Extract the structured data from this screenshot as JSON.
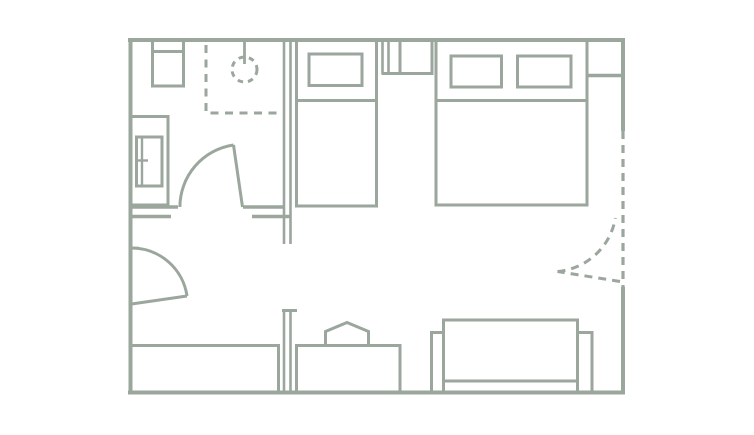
{
  "canvas": {
    "width": 754,
    "height": 435,
    "background": "#ffffff"
  },
  "plan": {
    "title": "hotel-room-floor-plan",
    "stroke_color": "#9ba69d",
    "fill_color": "none",
    "elements": [
      {
        "type": "line",
        "name": "wall-top",
        "x1": 128,
        "y1": 40,
        "x2": 625,
        "y2": 40,
        "sw": 4
      },
      {
        "type": "line",
        "name": "wall-left",
        "x1": 130.5,
        "y1": 38,
        "x2": 130.5,
        "y2": 394,
        "sw": 4
      },
      {
        "type": "line",
        "name": "wall-bottom",
        "x1": 128,
        "y1": 392.5,
        "x2": 625,
        "y2": 392.5,
        "sw": 4
      },
      {
        "type": "line",
        "name": "wall-right-upper",
        "x1": 623,
        "y1": 38,
        "x2": 623,
        "y2": 131,
        "sw": 4
      },
      {
        "type": "line",
        "name": "balcony-wall-dashed",
        "x1": 623,
        "y1": 131,
        "x2": 623,
        "y2": 289,
        "sw": 3.2,
        "dash": "8 6"
      },
      {
        "type": "line",
        "name": "wall-right-lower",
        "x1": 623,
        "y1": 287,
        "x2": 623,
        "y2": 394,
        "sw": 4
      },
      {
        "type": "line",
        "name": "bathroom-partition-outer",
        "x1": 284,
        "y1": 40,
        "x2": 284,
        "y2": 244,
        "sw": 2.6
      },
      {
        "type": "line",
        "name": "bathroom-partition-inner",
        "x1": 290.5,
        "y1": 40,
        "x2": 290.5,
        "y2": 244,
        "sw": 2.6
      },
      {
        "type": "line",
        "name": "bathroom-south-wall-left-outer",
        "x1": 129,
        "y1": 207,
        "x2": 178,
        "y2": 207,
        "sw": 3.5
      },
      {
        "type": "line",
        "name": "bathroom-south-wall-left-inner",
        "x1": 129,
        "y1": 216.5,
        "x2": 171,
        "y2": 216.5,
        "sw": 3.5
      },
      {
        "type": "line",
        "name": "bathroom-south-wall-right-outer",
        "x1": 243,
        "y1": 207,
        "x2": 285,
        "y2": 207,
        "sw": 3.5
      },
      {
        "type": "line",
        "name": "bathroom-south-wall-right-inner",
        "x1": 252,
        "y1": 216.5,
        "x2": 291.5,
        "y2": 216.5,
        "sw": 3.5
      },
      {
        "type": "line",
        "name": "hall-partition-outer",
        "x1": 284,
        "y1": 310,
        "x2": 284,
        "y2": 392,
        "sw": 2.6
      },
      {
        "type": "line",
        "name": "hall-partition-inner",
        "x1": 290.5,
        "y1": 310,
        "x2": 290.5,
        "y2": 392,
        "sw": 2.6
      },
      {
        "type": "line",
        "name": "hall-partition-cap",
        "x1": 282,
        "y1": 310.5,
        "x2": 297,
        "y2": 310.5,
        "sw": 3
      },
      {
        "type": "line",
        "name": "bedroom-divider-stub-outer",
        "x1": 382.5,
        "y1": 40,
        "x2": 382.5,
        "y2": 73.5,
        "sw": 2.6
      },
      {
        "type": "line",
        "name": "bedroom-divider-stub-inner",
        "x1": 388.5,
        "y1": 40,
        "x2": 388.5,
        "y2": 73.5,
        "sw": 2.6
      },
      {
        "type": "line",
        "name": "bedroom-divider-stub-cap",
        "x1": 381.5,
        "y1": 73.5,
        "x2": 400,
        "y2": 73.5,
        "sw": 3
      },
      {
        "type": "rect",
        "name": "sink",
        "x": 152.5,
        "y": 40,
        "w": 31,
        "h": 46,
        "sw": 3
      },
      {
        "type": "line",
        "name": "sink-basin-edge",
        "x1": 152.5,
        "y1": 51.5,
        "x2": 183.5,
        "y2": 51.5,
        "sw": 3
      },
      {
        "type": "rect",
        "name": "toilet-outer",
        "x": 130.5,
        "y": 116.5,
        "w": 37.5,
        "h": 88.5,
        "sw": 3
      },
      {
        "type": "rect",
        "name": "toilet-inner",
        "x": 136.5,
        "y": 137,
        "w": 25.5,
        "h": 49,
        "sw": 3
      },
      {
        "type": "line",
        "name": "toilet-divider",
        "x1": 142,
        "y1": 137,
        "x2": 142,
        "y2": 186,
        "sw": 2.4
      },
      {
        "type": "line",
        "name": "toilet-handle-tick",
        "x1": 135.5,
        "y1": 160.5,
        "x2": 148,
        "y2": 160.5,
        "sw": 2.4
      },
      {
        "type": "path",
        "name": "shower-enclosure-dashed",
        "d": "M 206 45 V 113 H 283",
        "sw": 3,
        "dash": "8 6.5"
      },
      {
        "type": "circle",
        "name": "shower-drain-circle",
        "cx": 244.5,
        "cy": 69.5,
        "r": 12.5,
        "sw": 3,
        "dash": "5.5 5"
      },
      {
        "type": "line",
        "name": "shower-head-line",
        "x1": 244.5,
        "y1": 40,
        "x2": 244.5,
        "y2": 64,
        "sw": 2.8
      },
      {
        "type": "line",
        "name": "bathroom-door-leaf",
        "x1": 242.5,
        "y1": 207,
        "x2": 233.5,
        "y2": 145,
        "sw": 3
      },
      {
        "type": "path",
        "name": "bathroom-door-swing-arc",
        "d": "M 179.9 207 A 62.7 62.7 0 0 1 233.5 145",
        "sw": 3
      },
      {
        "type": "line",
        "name": "entry-door-jamb-tick",
        "x1": 129,
        "y1": 248,
        "x2": 139,
        "y2": 248,
        "sw": 2.6
      },
      {
        "type": "line",
        "name": "entry-door-leaf",
        "x1": 131.5,
        "y1": 304,
        "x2": 187,
        "y2": 296,
        "sw": 3
      },
      {
        "type": "path",
        "name": "entry-door-swing-arc",
        "d": "M 131.5 248 A 56 56 0 0 1 187 296",
        "sw": 3
      },
      {
        "type": "line",
        "name": "balcony-door-leaf-dashed",
        "x1": 620,
        "y1": 281.5,
        "x2": 557.5,
        "y2": 271.5,
        "sw": 3,
        "dash": "8 6"
      },
      {
        "type": "path",
        "name": "balcony-door-swing-arc-dashed",
        "d": "M 557.5 271.5 A 64.4 64.4 0 0 0 615.4 218",
        "sw": 3,
        "dash": "8 6"
      },
      {
        "type": "rect",
        "name": "single-bed",
        "x": 296.5,
        "y": 40,
        "w": 80,
        "h": 166,
        "sw": 3
      },
      {
        "type": "rect",
        "name": "single-bed-pillow",
        "x": 309,
        "y": 54,
        "w": 53,
        "h": 31.5,
        "sw": 3
      },
      {
        "type": "line",
        "name": "single-bed-blanket-line",
        "x1": 296.5,
        "y1": 100.5,
        "x2": 376.5,
        "y2": 100.5,
        "sw": 3
      },
      {
        "type": "rect",
        "name": "nightstand",
        "x": 400,
        "y": 40,
        "w": 32,
        "h": 33.5,
        "sw": 3
      },
      {
        "type": "rect",
        "name": "double-bed",
        "x": 436,
        "y": 40,
        "w": 151,
        "h": 165,
        "sw": 3
      },
      {
        "type": "rect",
        "name": "double-bed-pillow-left",
        "x": 451,
        "y": 56,
        "w": 50.5,
        "h": 31,
        "sw": 3
      },
      {
        "type": "rect",
        "name": "double-bed-pillow-right",
        "x": 517.5,
        "y": 56,
        "w": 53.5,
        "h": 31,
        "sw": 3
      },
      {
        "type": "line",
        "name": "double-bed-blanket-line",
        "x1": 436,
        "y1": 100.5,
        "x2": 587,
        "y2": 100.5,
        "sw": 3
      },
      {
        "type": "line",
        "name": "closet-niche-shelf-line",
        "x1": 587,
        "y1": 75.5,
        "x2": 623,
        "y2": 75.5,
        "sw": 3.5
      },
      {
        "type": "rect",
        "name": "wardrobe",
        "x": 130.5,
        "y": 345.5,
        "w": 148,
        "h": 47,
        "sw": 3
      },
      {
        "type": "path",
        "name": "desk",
        "d": "M 296.5 392 V 345.5 H 400 V 392",
        "sw": 3
      },
      {
        "type": "path",
        "name": "desk-chair",
        "d": "M 325.5 345.5 V 331.5 L 347 322.5 L 368.5 331.5 V 345.5",
        "sw": 3
      },
      {
        "type": "rect",
        "name": "sofa-seat",
        "x": 443.5,
        "y": 320,
        "w": 134,
        "h": 61,
        "sw": 3
      },
      {
        "type": "rect",
        "name": "sofa-armrest-left",
        "x": 431.5,
        "y": 332.5,
        "w": 12,
        "h": 60,
        "sw": 3
      },
      {
        "type": "rect",
        "name": "sofa-armrest-right",
        "x": 577.5,
        "y": 332.5,
        "w": 14.5,
        "h": 60,
        "sw": 3
      }
    ]
  }
}
